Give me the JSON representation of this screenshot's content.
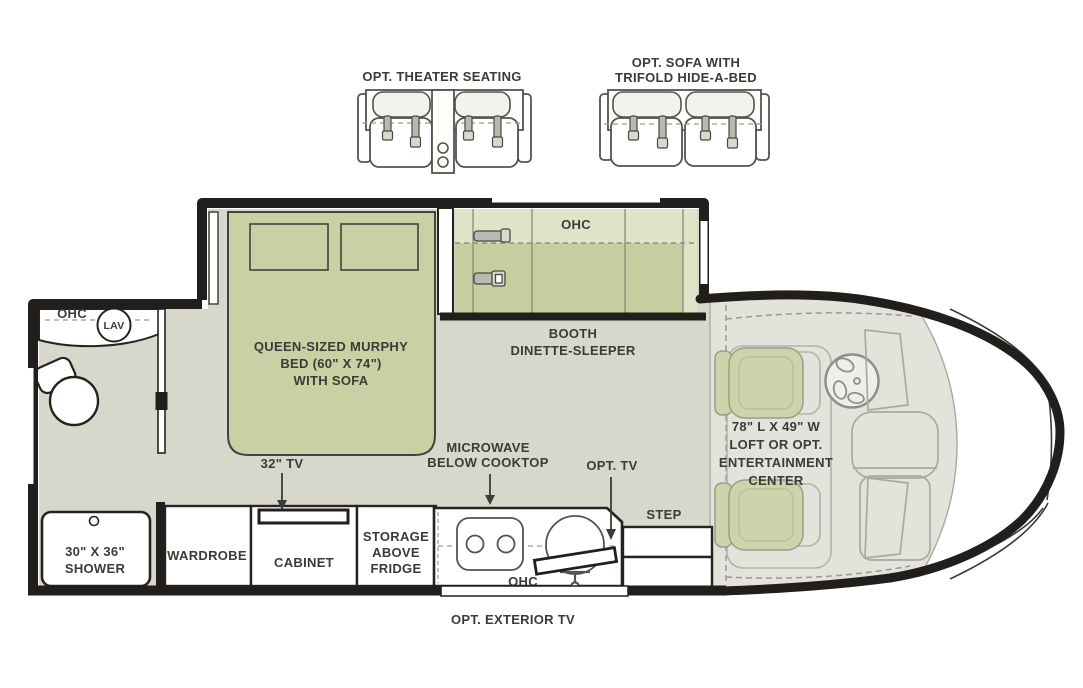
{
  "palette": {
    "wall": "#211e1c",
    "floor": "#d8d7cc",
    "cab_floor": "#e3e2db",
    "green": "#c9d0a3",
    "green_dark": "#c6cd9e",
    "green_light": "#dfe4c9",
    "seat_green": "#cdd3aa",
    "outline_gray": "#a9a9a1",
    "text": "#3b3b37"
  },
  "optional_furniture": {
    "theater_seating_label": "OPT. THEATER SEATING",
    "sofa_label_line1": "OPT. SOFA WITH",
    "sofa_label_line2": "TRIFOLD HIDE-A-BED"
  },
  "bathroom": {
    "ohc_label": "OHC",
    "lav_label": "LAV",
    "shower_label_line1": "30\" X 36\"",
    "shower_label_line2": "SHOWER"
  },
  "bedroom": {
    "murphy_bed_line1": "QUEEN-SIZED MURPHY",
    "murphy_bed_line2": "BED (60\" X 74\")",
    "murphy_bed_line3": "WITH SOFA",
    "tv_label": "32\" TV",
    "wardrobe_label": "WARDROBE",
    "cabinet_label": "CABINET"
  },
  "dinette": {
    "ohc_label": "OHC",
    "label_line1": "BOOTH",
    "label_line2": "DINETTE-SLEEPER"
  },
  "kitchen": {
    "microwave_label_line1": "MICROWAVE",
    "microwave_label_line2": "BELOW COOKTOP",
    "opt_tv_label": "OPT. TV",
    "ohc_label": "OHC",
    "storage_label_line1": "STORAGE",
    "storage_label_line2": "ABOVE",
    "storage_label_line3": "FRIDGE",
    "exterior_tv_label": "OPT.  EXTERIOR TV"
  },
  "entry": {
    "step_label": "STEP"
  },
  "cab": {
    "loft_label_line1": "78\" L X 49\" W",
    "loft_label_line2": "LOFT OR OPT.",
    "loft_label_line3": "ENTERTAINMENT",
    "loft_label_line4": "CENTER"
  }
}
